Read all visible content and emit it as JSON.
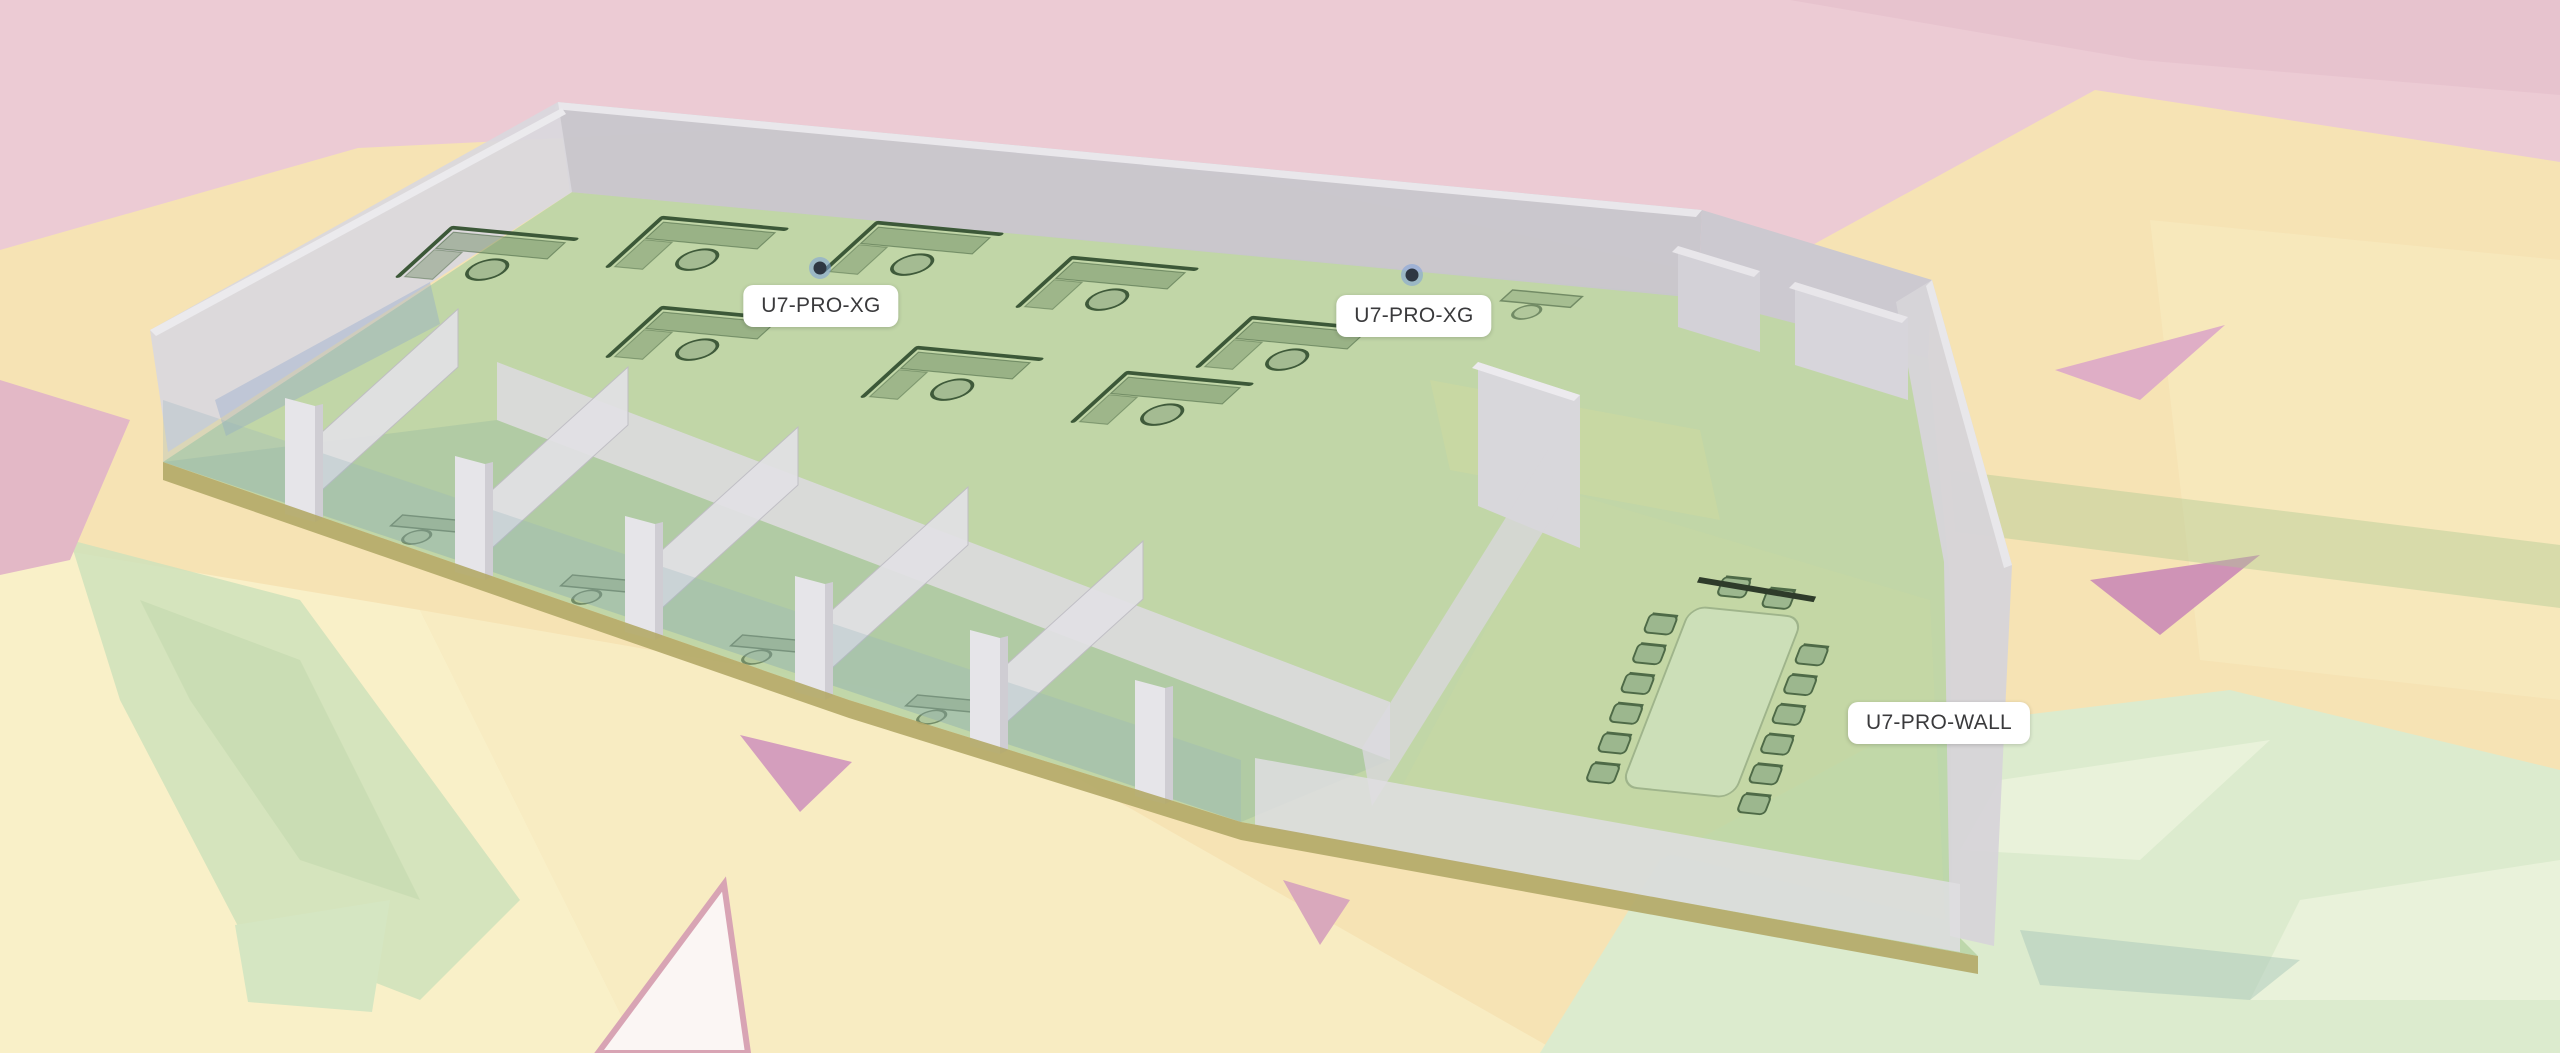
{
  "viewport": {
    "description": "3D wireless coverage view of office floor plan"
  },
  "access_points": [
    {
      "label": "U7-PRO-XG"
    },
    {
      "label": "U7-PRO-XG"
    },
    {
      "label": "U7-PRO-WALL"
    }
  ],
  "colors": {
    "heat_strong": "#b7d3a5",
    "heat_good": "#dcebce",
    "heat_good_light": "#e9f2da",
    "heat_fair": "#f6e3b4",
    "heat_fair_light": "#f9f0c8",
    "heat_weak": "#eccbd4",
    "heat_none": "#fbf6f4",
    "wall": "#d6d4d9",
    "wall_dark": "#c8c6cc",
    "wall_light": "#e6e5e9",
    "slab_edge": "#b3a967",
    "furniture": "#3f5a3a",
    "table": "#cde0ba",
    "ap_ring": "#7ba1dd",
    "label_bg": "#ffffff",
    "label_text": "#3a3a3c"
  }
}
